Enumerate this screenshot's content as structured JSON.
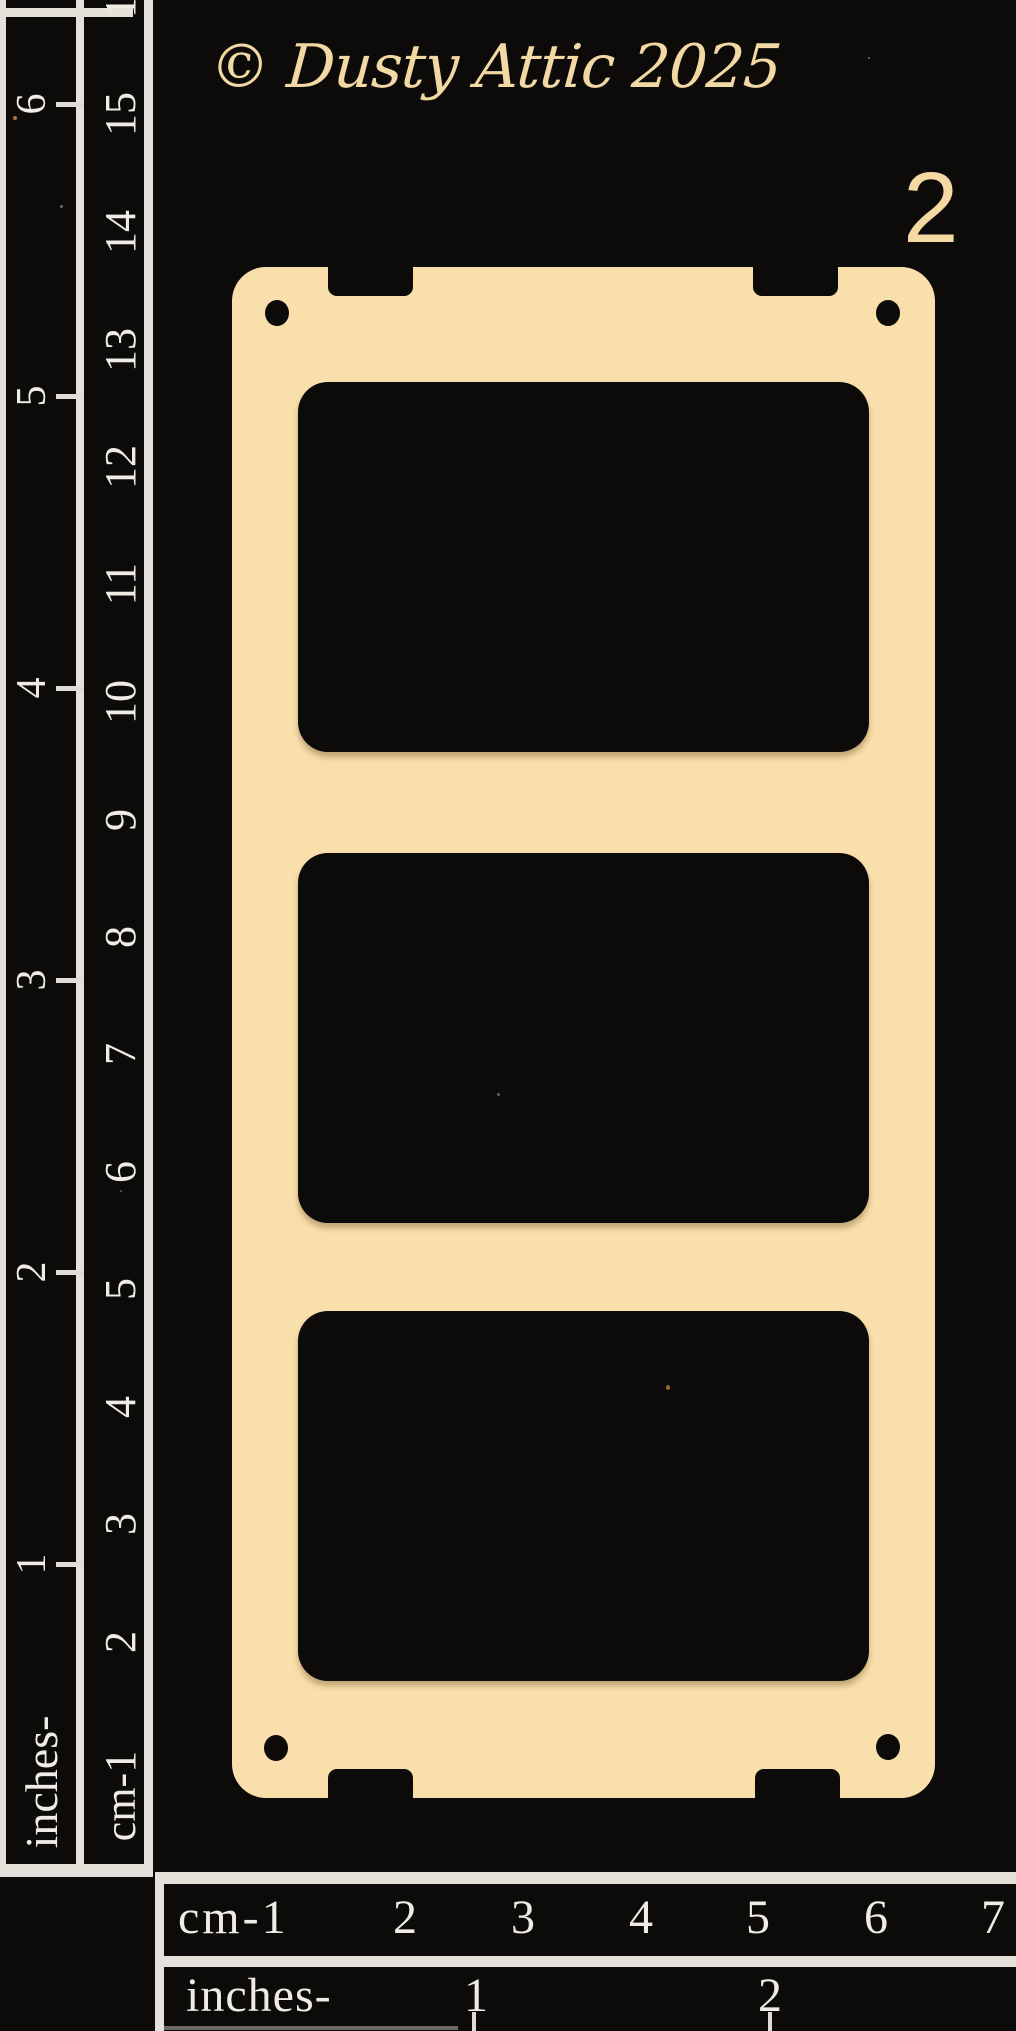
{
  "header": {
    "copyright_text": "© Dusty Attic 2025",
    "sheet_number": "2"
  },
  "board": {
    "color": "#f9dfac",
    "window_count": 3
  },
  "left_ruler": {
    "cm_numbers": [
      "16",
      "15",
      "14",
      "13",
      "12",
      "11",
      "10",
      "9",
      "8",
      "7",
      "6",
      "5",
      "4",
      "3",
      "2"
    ],
    "cm_label": "cm-1",
    "inch_numbers": [
      "6",
      "5",
      "4",
      "3",
      "2",
      "1"
    ],
    "inches_label": "inches-"
  },
  "bottom_ruler": {
    "cm_label": "cm-1",
    "cm_numbers": [
      "2",
      "3",
      "4",
      "5",
      "6",
      "7"
    ],
    "inches_label": "inches-",
    "inch_numbers": [
      "1",
      "2"
    ]
  },
  "colors": {
    "background": "#0c0b09",
    "board": "#f9dfac",
    "ruler_ink": "#efece5",
    "accent_text": "#f2d8a3"
  }
}
